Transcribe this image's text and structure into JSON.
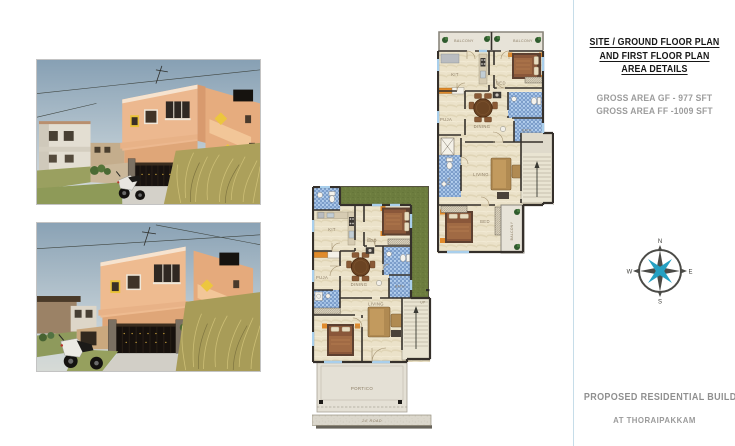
{
  "panel": {
    "title_lines": [
      "SITE / GROUND FLOOR PLAN",
      "AND FIRST FLOOR PLAN",
      "AREA DETAILS"
    ],
    "area_lines": [
      "GROSS AREA GF - 977 SFT",
      "GROSS AREA FF -1009 SFT"
    ],
    "footer_line1": "PROPOSED RESIDENTIAL BUILDING",
    "footer_line2": "AT THORAIPAKKAM"
  },
  "compass": {
    "north": "N",
    "east": "E",
    "south": "S",
    "west": "W"
  },
  "plans": {
    "ground_floor": {
      "labels": {
        "kit": "KIT",
        "bed_top": "BED",
        "puja": "PUJA",
        "dining": "DINING",
        "bath": "BATH",
        "living": "LIVING",
        "up": "UP",
        "portico": "PORTICO",
        "road": "24'  ROAD"
      }
    },
    "first_floor": {
      "labels": {
        "balcony_left": "BALCONY",
        "balcony_right": "BALCONY",
        "kit": "KIT",
        "bed_top": "BED",
        "puja": "PUJA",
        "dining": "DINING",
        "bath": "BATH",
        "toilet": "TOIL",
        "living": "LIVING",
        "bed_bottom": "BED",
        "balcony_side": "BALCONY"
      }
    }
  },
  "colors": {
    "accent_teal": "#25a0c2",
    "wall": "#35302b",
    "lawn_green": "#6d7d3f",
    "tile_blue": "#4a77b4",
    "floor_cream": "#ebe2c9",
    "road_gray": "#dbd7cc",
    "title_text": "#161616",
    "muted_text": "#9c9c9c"
  }
}
